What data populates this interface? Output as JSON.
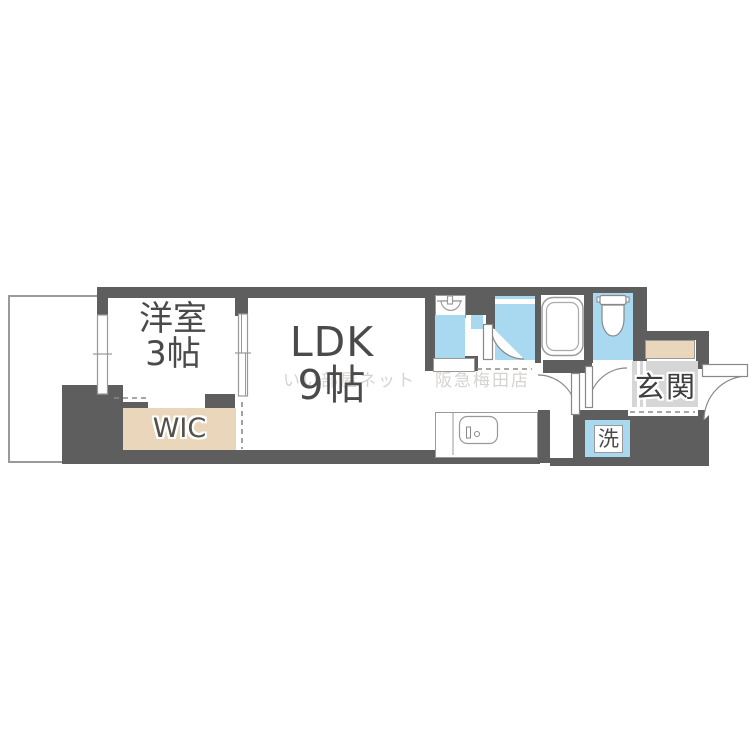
{
  "floorplan": {
    "rooms": {
      "bedroom": {
        "line1": "洋室",
        "line2": "3帖"
      },
      "ldk": {
        "line1": "LDK",
        "line2": "9帖"
      },
      "wic": {
        "label": "WIC"
      },
      "entrance": {
        "label": "玄関"
      },
      "laundry": {
        "label": "洗"
      }
    },
    "watermark": {
      "text": "いい部屋ネット　阪急梅田店"
    },
    "colors": {
      "wall": "#5e5e5e",
      "wet_area": "#a9d9f1",
      "closet": "#e9d6bb",
      "entrance_floor": "#d6d6d6",
      "outline": "#999999",
      "label_text": "#4a4a4a"
    }
  }
}
